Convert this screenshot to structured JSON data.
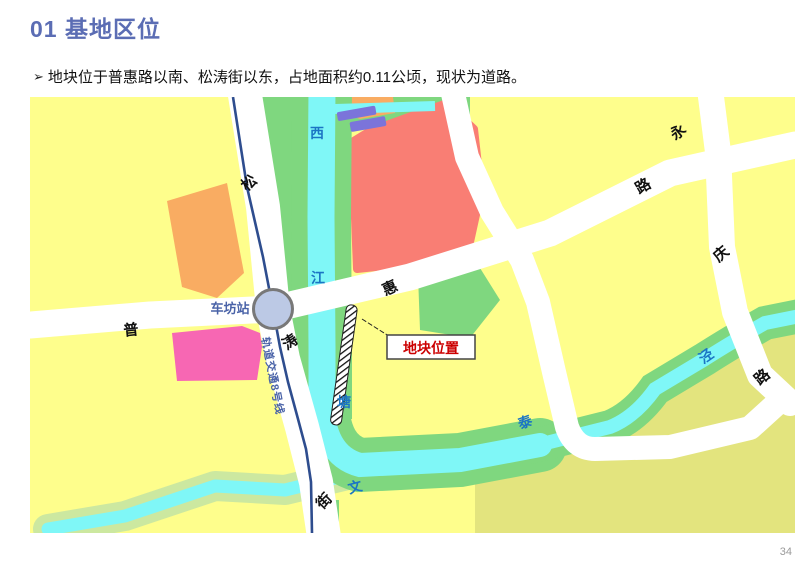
{
  "page": {
    "title": "01 基地区位",
    "bullet": {
      "marker": "➢",
      "text": "地块位于普惠路以南、松涛街以东，占地面积约0.11公顷，现状为道路。"
    },
    "page_number": "34"
  },
  "map": {
    "station_label": "车坊站",
    "rail_line_label": "轨道交通8号线",
    "site_label": "地块位置",
    "river_labels": {
      "xi": "西",
      "jiang": "江",
      "tang": "塘",
      "wen": "文",
      "tai": "泰",
      "jing": "泾"
    },
    "road_labels": {
      "pu": "普",
      "hui": "惠",
      "lu1": "路",
      "song": "松",
      "tao": "涛",
      "jie": "街",
      "yong": "永",
      "qing": "庆",
      "lu2": "路"
    },
    "colors": {
      "title_blue": "#5B6DB4",
      "parcel_yellow": "#FEFE8C",
      "parcel_olive": "#E3E47E",
      "parcel_green": "#7FD77F",
      "parcel_orange": "#F9AC62",
      "parcel_red": "#F97E74",
      "parcel_pink": "#F767B3",
      "water_cyan": "#7FF7F7",
      "bank_pale_green": "#CCE8A0",
      "road_white": "#FFFFFF",
      "rail_blue": "#2E4D8E",
      "metro_station_fill": "#BCC9E5",
      "river_label_blue": "#1B75C4",
      "station_label_blue": "#4A63A8",
      "site_label_red": "#CC0000",
      "bridge_purple": "#7B74DA"
    }
  }
}
